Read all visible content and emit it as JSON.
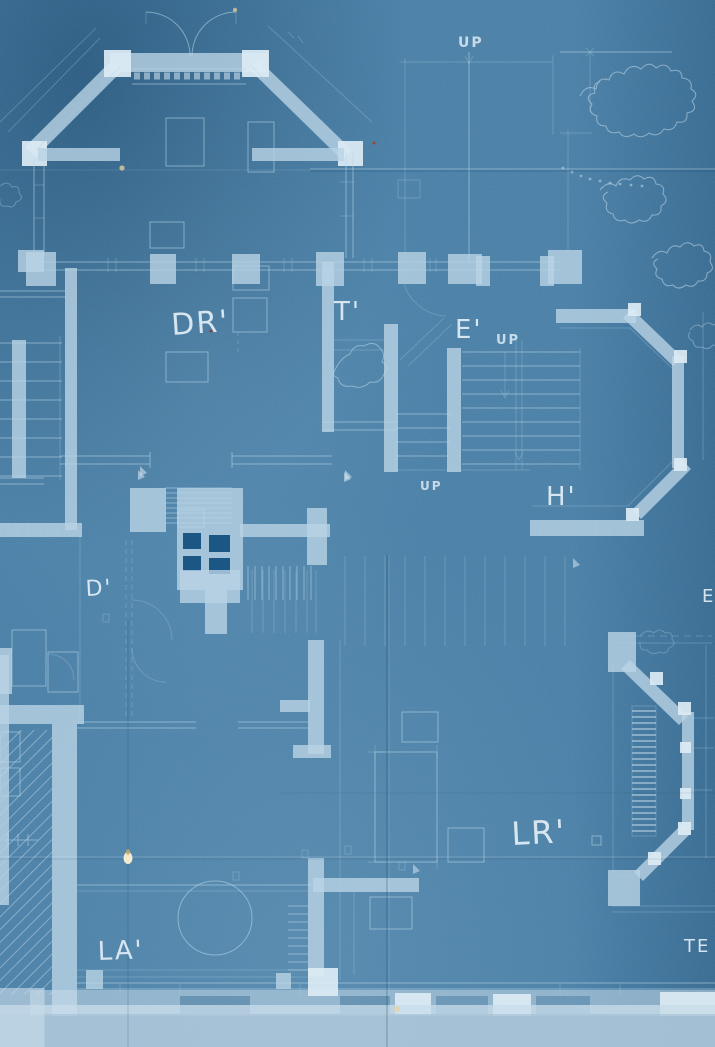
{
  "document": {
    "kind": "cyanotype blueprint first-floor plan",
    "colors": {
      "paper_blue": "#1d5f92",
      "paper_blue_dark": "#15507e",
      "line_pale": "#cfe3f0",
      "wall_fill": "#b9d3e5",
      "wall_bright": "#dcebf4",
      "damage_cream": "#f0e6c8"
    },
    "rooms": [
      {
        "id": "dining-room",
        "label": "DR'"
      },
      {
        "id": "toilet",
        "label": "T'"
      },
      {
        "id": "entry",
        "label": "E'"
      },
      {
        "id": "hall",
        "label": "H'"
      },
      {
        "id": "pantry",
        "label": "D'"
      },
      {
        "id": "living-room",
        "label": "LR'"
      },
      {
        "id": "lavatory",
        "label": "LA'"
      },
      {
        "id": "terrace-partial",
        "label": "TE"
      },
      {
        "id": "edge-partial",
        "label": "E"
      }
    ],
    "annotations": [
      {
        "id": "up-top",
        "label": "UP"
      },
      {
        "id": "up-entry",
        "label": "UP"
      },
      {
        "id": "up-center",
        "label": "UP"
      }
    ]
  }
}
